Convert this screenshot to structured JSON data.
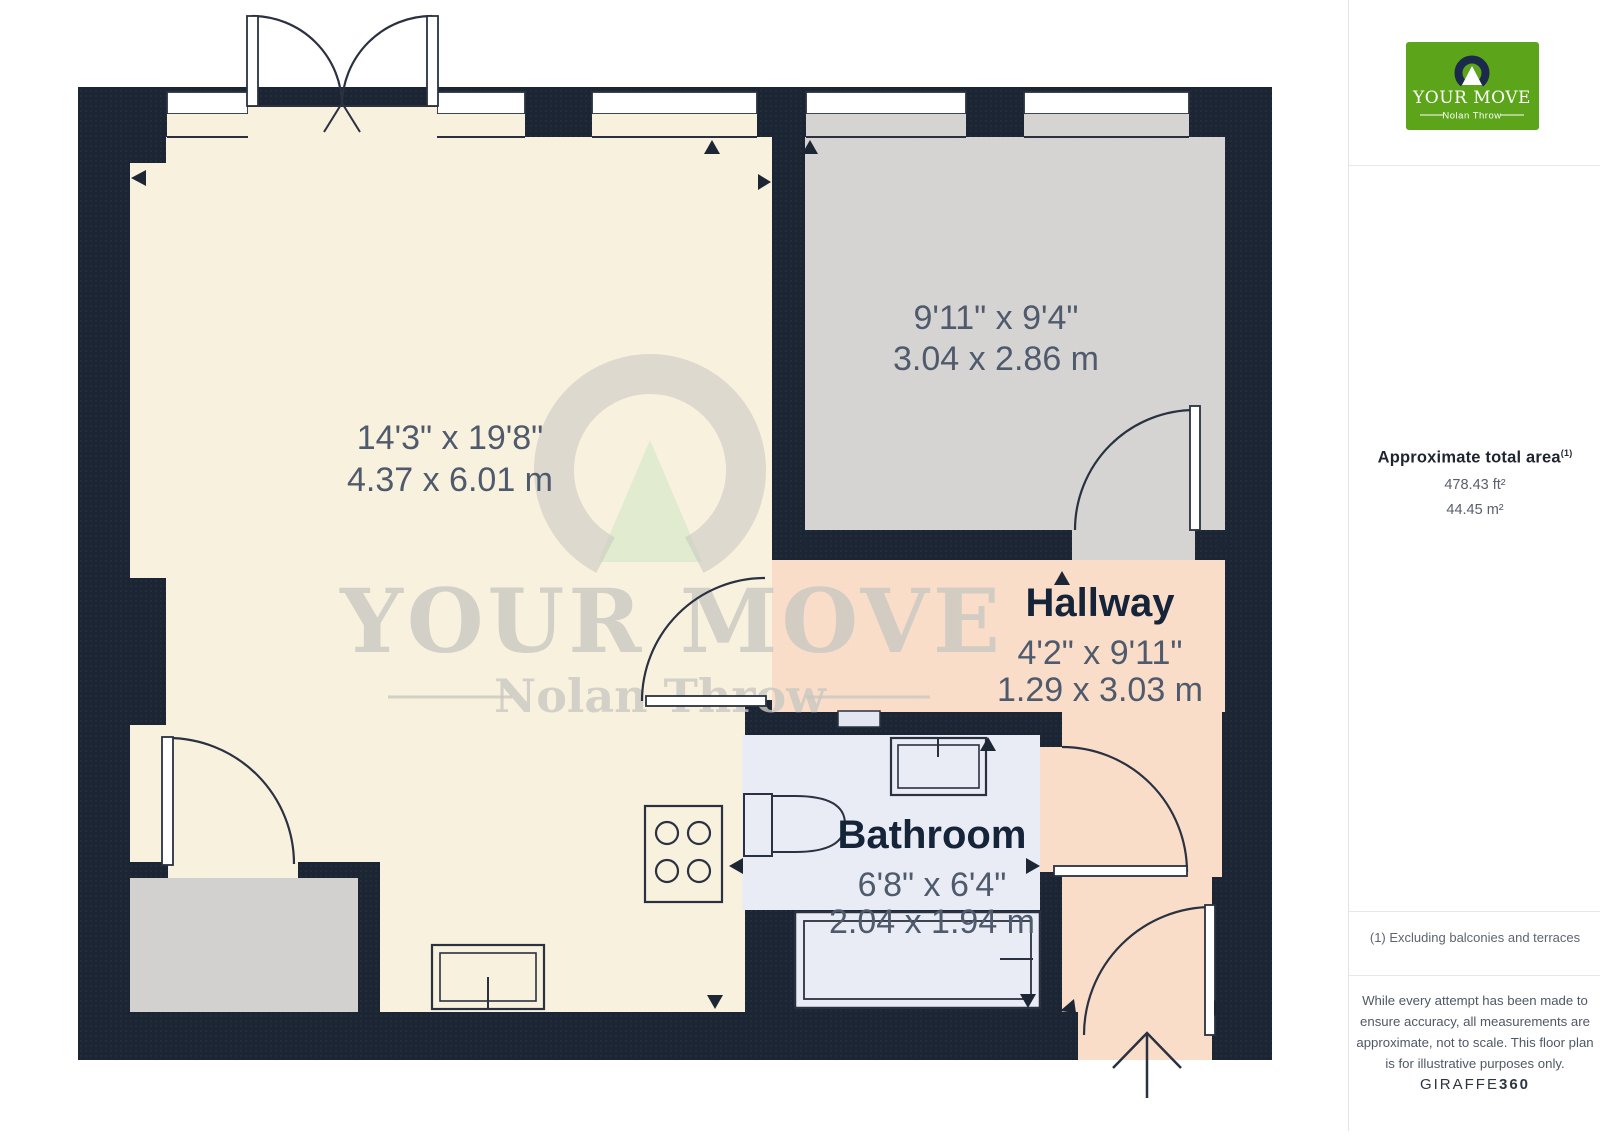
{
  "plan": {
    "rooms": {
      "living": {
        "dims_imperial": "14'3\" x 19'8\"",
        "dims_metric": "4.37 x 6.01 m"
      },
      "bedroom": {
        "dims_imperial": "9'11\" x 9'4\"",
        "dims_metric": "3.04 x 2.86 m"
      },
      "hallway": {
        "name": "Hallway",
        "dims_imperial": "4'2\" x 9'11\"",
        "dims_metric": "1.29 x 3.03 m"
      },
      "bathroom": {
        "name": "Bathroom",
        "dims_imperial": "6'8\" x 6'4\"",
        "dims_metric": "2.04 x 1.94 m"
      }
    },
    "colors": {
      "wall": "#1c2533",
      "living": "#f8f1de",
      "bedroom": "#d5d4d2",
      "hallway": "#f9ddc8",
      "bathroom": "#e9ecf5",
      "balcony": "#d2d1cf"
    }
  },
  "watermark": {
    "brand": "YOUR MOVE",
    "sub": "Nolan Throw"
  },
  "sidebar": {
    "logo": {
      "brand": "YOUR MOVE",
      "sub": "Nolan Throw",
      "brand_green": "#5ca41a",
      "navy": "#1b2a4a"
    },
    "area": {
      "title": "Approximate total area",
      "sup": "(1)",
      "imperial": "478.43 ft²",
      "metric": "44.45 m²"
    },
    "footnote": "(1) Excluding balconies and terraces",
    "disclaimer": "While every attempt has been made to ensure accuracy, all measurements are approximate, not to scale. This floor plan is for illustrative purposes only.",
    "brand": "GIRAFFE",
    "brand_suffix": "360"
  }
}
